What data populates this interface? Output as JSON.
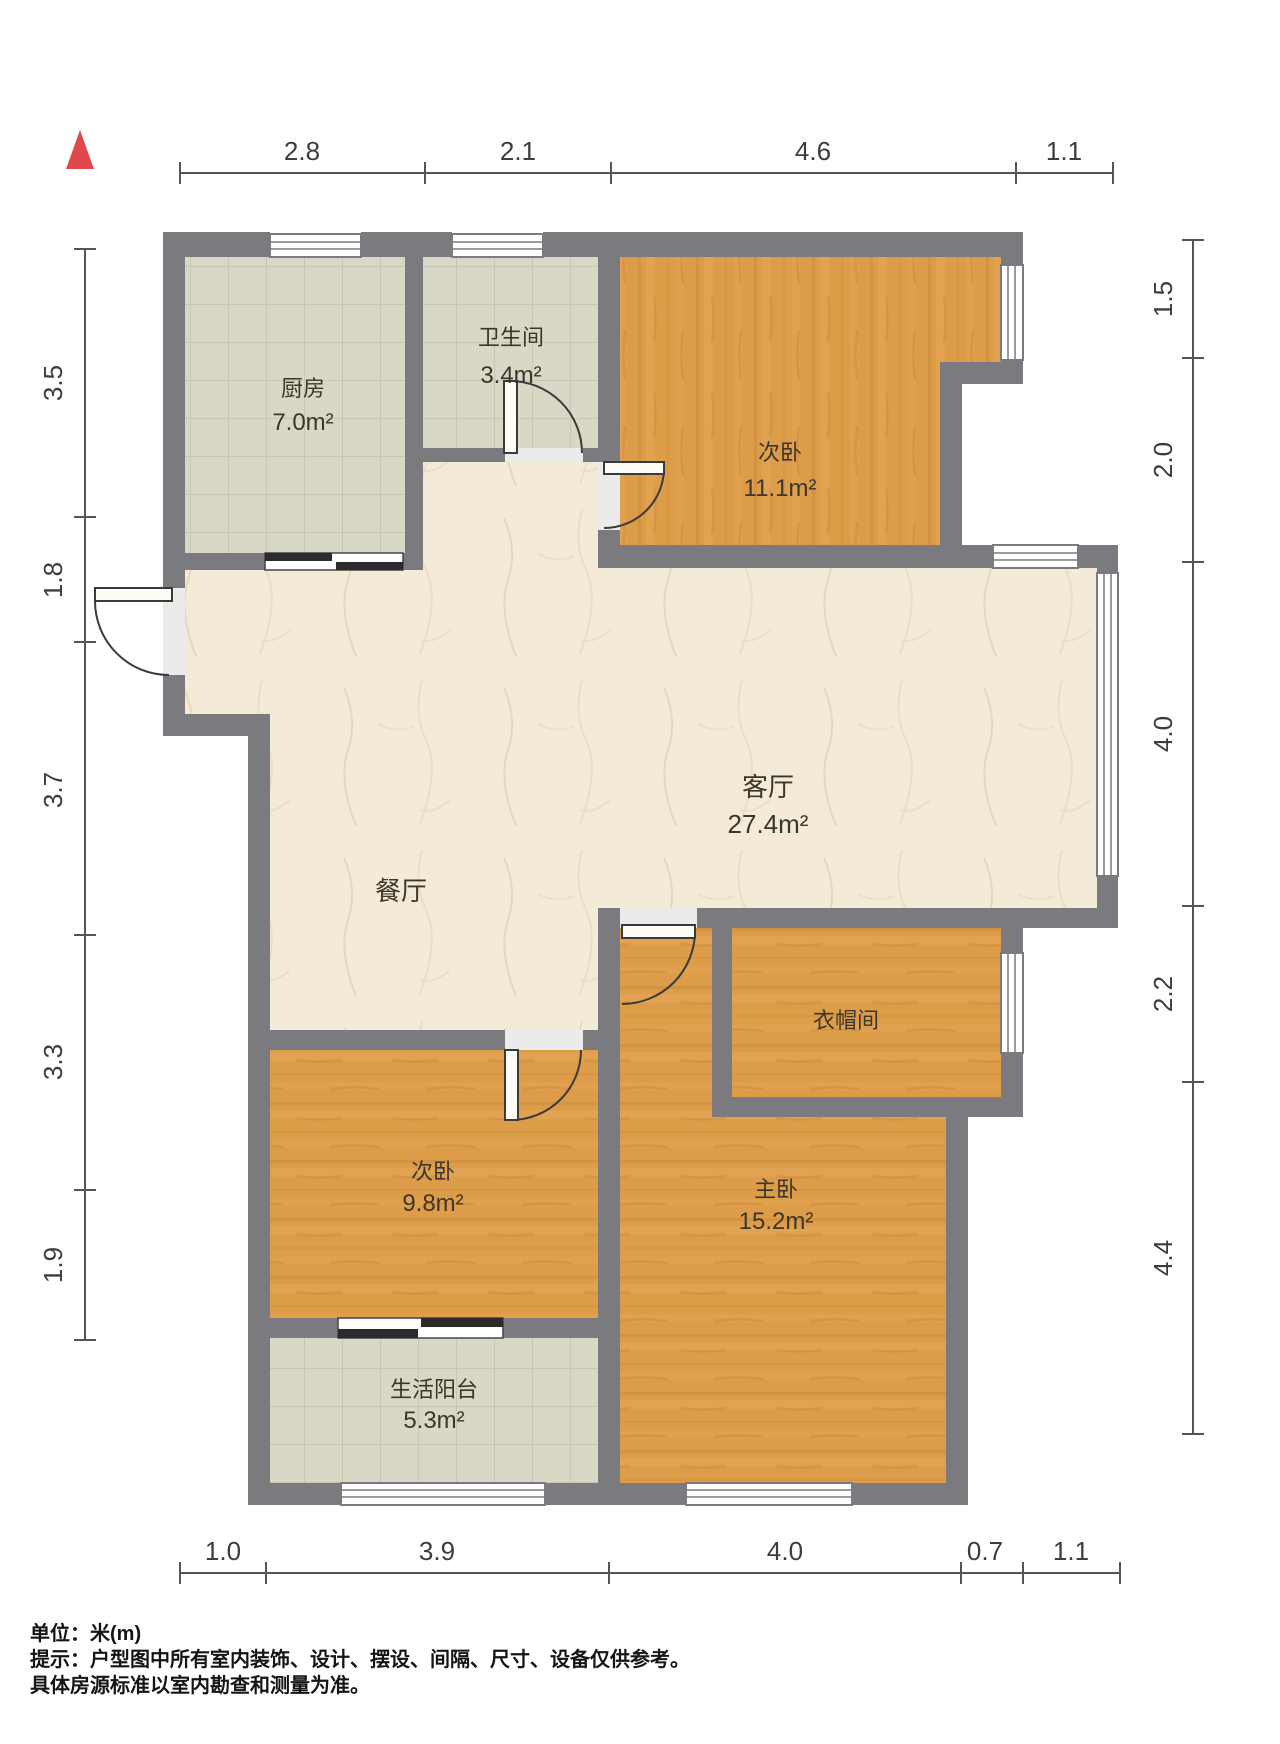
{
  "plan": {
    "rooms": [
      {
        "name": "厨房",
        "area": "7.0m²"
      },
      {
        "name": "卫生间",
        "area": "3.4m²"
      },
      {
        "name": "次卧",
        "area": "11.1m²"
      },
      {
        "name": "客厅",
        "area": "27.4m²"
      },
      {
        "name": "餐厅",
        "area": ""
      },
      {
        "name": "衣帽间",
        "area": ""
      },
      {
        "name": "次卧",
        "area": "9.8m²"
      },
      {
        "name": "主卧",
        "area": "15.2m²"
      },
      {
        "name": "生活阳台",
        "area": "5.3m²"
      }
    ],
    "dimensions": {
      "top": [
        "2.8",
        "2.1",
        "4.6",
        "1.1"
      ],
      "left": [
        "3.5",
        "1.8",
        "3.7",
        "3.3",
        "1.9"
      ],
      "right": [
        "1.5",
        "2.0",
        "4.0",
        "2.2",
        "4.4"
      ],
      "bottom": [
        "1.0",
        "3.9",
        "4.0",
        "0.7",
        "1.1"
      ]
    },
    "north_indicator": "north-arrow",
    "colors": {
      "wall": "#7a7a7f",
      "tile_floor": "#d9d8c6",
      "wood_floor": "#dd9c48",
      "marble_floor": "#f3ebd8",
      "north_arrow": "#e0484d",
      "dim_text": "#3d3d3d"
    }
  },
  "footer": {
    "unit_line": "单位：米(m)",
    "tip_line": "提示：户型图中所有室内装饰、设计、摆设、间隔、尺寸、设备仅供参考。",
    "note_line": "具体房源标准以室内勘查和测量为准。"
  }
}
